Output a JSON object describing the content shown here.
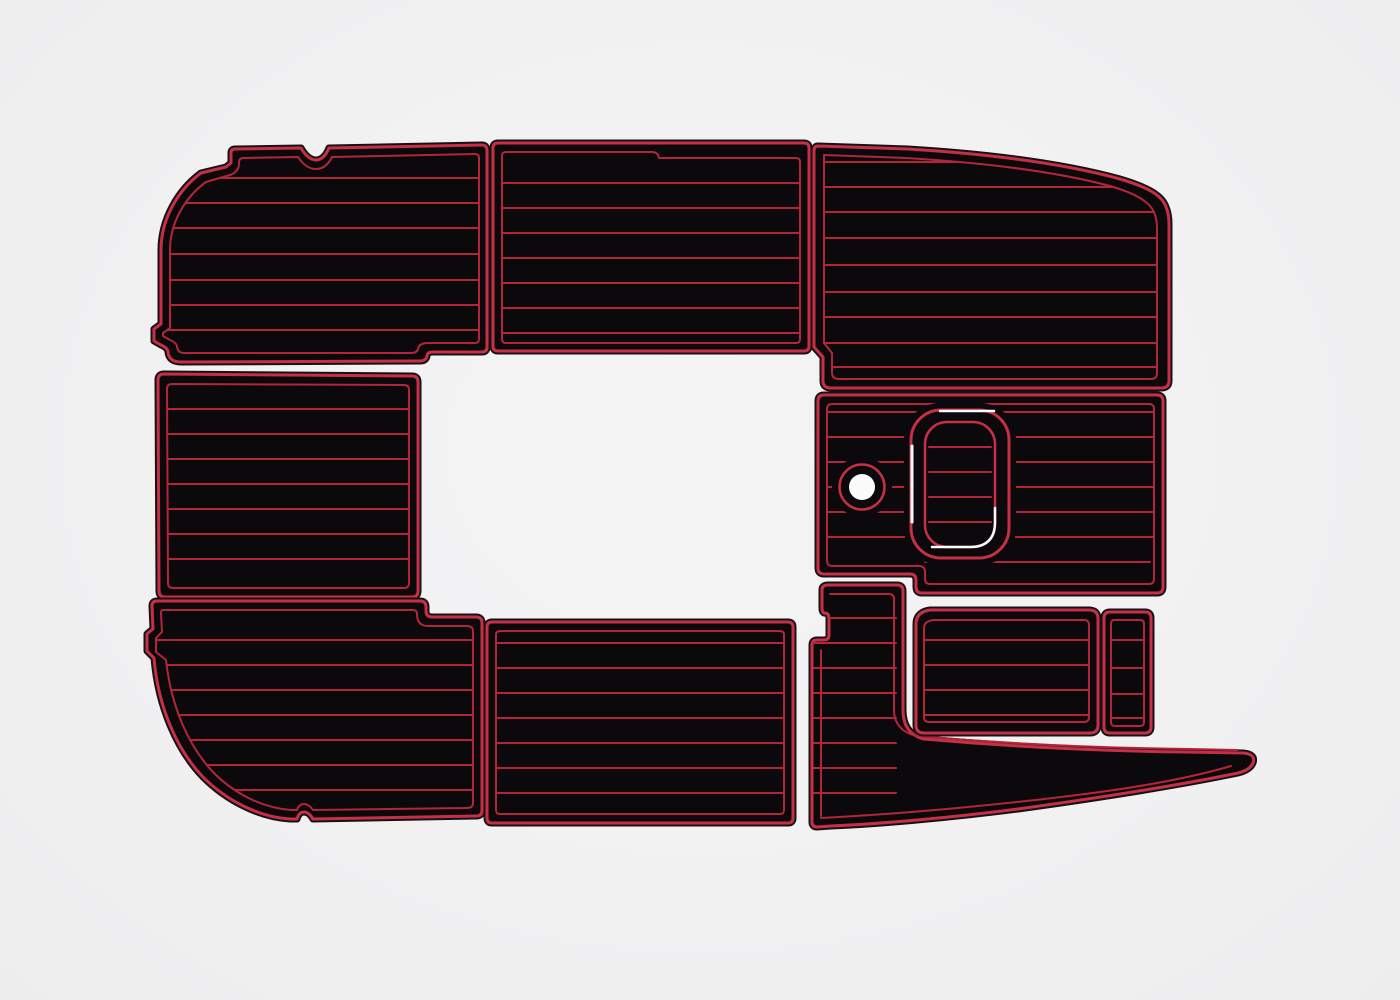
{
  "scene": {
    "width": 1400,
    "height": 1000,
    "colors": {
      "bg": "#f1f1f2",
      "pad": "#0b090c",
      "rim": "#141216",
      "edge": "#c62f44",
      "line": "#b3253a",
      "white": "#fbfbfc"
    }
  },
  "panels": [
    {
      "name": "bow-port-pad",
      "outline": "M 235,149 L 301,148 Q 308,160 316,160 Q 324,160 329,148 L 482,145 Q 487,145 487,151 L 487,347 Q 487,352 482,352 L 433,352 Q 427,352 427,356 Q 426,361 420,361 L 181,362 Q 169,362 168,352 Q 168,348 161,345 L 154,341 L 154,329 L 161,324 L 161,250 C 161,219 178,190 201,173 L 226,167 L 231,163 L 231,153 Q 231,149 235,149 Z",
      "inner": "M 243,158 L 298,157 Q 306,169 316,169 Q 326,169 332,157 L 475,154 Q 479,154 479,158 L 479,339 Q 479,343 475,343 L 428,343 Q 419,343 418,349 Q 417,353 411,353 L 184,353 Q 178,353 177,347 Q 177,343 170,340 L 163,336 L 163,333 L 170,328 L 170,250 C 170,223 185,197 206,182 L 230,175 Q 239,172 239,163 Q 239,158 243,158 Z",
      "clip": "inner",
      "grooves": {
        "x1": 158,
        "x2": 482,
        "ys": [
          178,
          203,
          228,
          254,
          280,
          305,
          330
        ]
      },
      "extras": []
    },
    {
      "name": "bow-center-pad",
      "outline": "M 498,143 L 804,143 Q 809,143 809,148 L 809,346 Q 809,351 804,351 L 498,351 Q 493,351 493,346 L 493,148 Q 493,143 498,143 Z",
      "inner": "M 506,152 L 652,152 Q 658,152 659,158 L 796,158 Q 800,158 800,162 L 800,339 Q 800,343 796,343 L 506,343 Q 502,343 502,339 L 502,156 Q 502,152 506,152 Z",
      "clip": "inner",
      "grooves": {
        "x1": 500,
        "x2": 802,
        "ys": [
          183,
          208,
          233,
          258,
          283,
          308,
          333
        ]
      },
      "extras": []
    },
    {
      "name": "bow-starboard-pad",
      "outline": "M 818,146 L 908,149 C 990,154 1065,164 1120,179 C 1147,187 1162,195 1166,207 Q 1169,214 1169,224 L 1169,381 Q 1169,388 1161,388 L 831,388 Q 823,388 823,381 L 823,357 L 814,347 L 814,151 Q 814,146 818,146 Z",
      "inner": "M 824,155 L 906,158 C 988,163 1058,172 1110,186 C 1134,193 1149,201 1154,212 Q 1157,219 1157,228 L 1157,373 Q 1157,379 1151,379 L 839,379 Q 832,379 832,372 L 832,353 L 824,343 Z",
      "clip": "inner",
      "grooves": {
        "x1": 820,
        "x2": 1160,
        "ys": [
          162,
          187,
          212,
          238,
          265,
          292,
          317,
          343,
          367
        ]
      },
      "extras": []
    },
    {
      "name": "midship-port-pad",
      "outline": "M 164,374 L 412,376 Q 418,376 418,382 L 418,591 Q 418,597 412,597 L 165,597 Q 159,597 159,591 L 158,380 Q 158,374 164,374 Z",
      "inner": "M 172,384 L 404,385 Q 409,385 409,390 L 409,583 Q 409,588 404,588 L 173,588 Q 168,588 168,583 L 167,389 Q 167,384 172,384 Z",
      "clip": "inner",
      "grooves": {
        "x1": 164,
        "x2": 412,
        "ys": [
          409,
          434,
          459,
          484,
          509,
          534,
          559
        ]
      },
      "extras": []
    },
    {
      "name": "helm-deck-pad",
      "outline": "M 824,395 L 1157,395 Q 1163,395 1163,401 L 1163,587 Q 1163,593 1157,593 L 922,593 Q 916,593 916,587 L 916,580 Q 916,574 910,574 L 824,574 Q 818,574 818,568 L 818,401 Q 818,395 824,395 Z",
      "inner": "M 832,404 L 1149,404 Q 1154,404 1154,409 L 1154,579 Q 1154,584 1149,584 L 930,584 Q 925,584 925,579 L 925,572 Q 925,566 919,566 L 833,566 Q 827,566 827,561 L 827,409 Q 827,404 832,404 Z",
      "clip": "inner",
      "grooves": {
        "x1": 822,
        "x2": 1158,
        "ys": [
          412,
          437,
          462,
          487,
          512,
          537
        ]
      },
      "extras": [
        {
          "t": "line",
          "x1": 925,
          "y1": 562,
          "x2": 1150,
          "y2": 562,
          "s": "line",
          "sw": 2
        },
        {
          "t": "rect",
          "x": 904,
          "y": 403,
          "w": 112,
          "h": 162,
          "rx": 36,
          "f": "pad"
        },
        {
          "t": "rect",
          "x": 911,
          "y": 410,
          "w": 98,
          "h": 148,
          "rx": 30,
          "s": "edge",
          "sw": 3
        },
        {
          "t": "path",
          "d": "M 912,446 L 912,522",
          "s": "white",
          "sw": 3
        },
        {
          "t": "path",
          "d": "M 940,411 L 994,411",
          "s": "white",
          "sw": 2.5
        },
        {
          "t": "circle",
          "cx": 862,
          "cy": 487,
          "r": 30,
          "f": "pad"
        },
        {
          "t": "circle",
          "cx": 862,
          "cy": 487,
          "r": 22.5,
          "s": "edge",
          "sw": 2.5
        },
        {
          "t": "circle",
          "cx": 862,
          "cy": 487,
          "r": 13,
          "f": "white"
        },
        {
          "t": "rect",
          "x": 925,
          "y": 422,
          "w": 70,
          "h": 125,
          "rx": 22,
          "f": "pad",
          "s": "edge",
          "sw": 2.5
        },
        {
          "t": "line",
          "x1": 929,
          "y1": 447,
          "x2": 991,
          "y2": 447,
          "s": "line",
          "sw": 2
        },
        {
          "t": "line",
          "x1": 929,
          "y1": 472,
          "x2": 991,
          "y2": 472,
          "s": "line",
          "sw": 2
        },
        {
          "t": "line",
          "x1": 929,
          "y1": 497,
          "x2": 991,
          "y2": 497,
          "s": "line",
          "sw": 2
        },
        {
          "t": "line",
          "x1": 929,
          "y1": 522,
          "x2": 991,
          "y2": 522,
          "s": "line",
          "sw": 2
        },
        {
          "t": "path",
          "d": "M 932,547 L 970,547 Q 995,547 995,522 L 995,508",
          "s": "white",
          "sw": 2.5
        }
      ]
    },
    {
      "name": "aft-port-pad",
      "outline": "M 157,601 L 420,601 Q 426,601 426,607 L 426,611 Q 426,617 432,617 L 476,617 Q 482,617 482,623 L 482,811 Q 482,816 476,816 L 313,819 Q 309,812 304,812 Q 299,812 297,819 L 290,819 C 258,817 226,800 203,777 C 177,750 158,707 154,658 L 147,651 L 147,634 L 153,629 L 152,606 Q 152,601 157,601 Z",
      "inner": "M 163,610 L 413,610 Q 417,610 417,614 Q 417,626 428,626 L 467,626 Q 473,626 473,631 L 473,803 Q 473,808 467,808 L 313,810 Q 309,804 304,804 Q 299,804 297,810 L 291,810 C 262,808 233,793 212,771 C 188,745 171,706 166,660 L 156,652 L 156,638 L 162,632 L 161,613 Q 161,610 163,610 Z",
      "clip": "inner",
      "grooves": {
        "x1": 150,
        "x2": 478,
        "ys": [
          640,
          665,
          690,
          715,
          740,
          765,
          790
        ]
      },
      "extras": []
    },
    {
      "name": "aft-center-pad",
      "outline": "M 492,622 L 788,622 Q 793,622 793,627 L 793,818 Q 793,823 788,823 L 492,823 Q 487,823 487,818 L 487,627 Q 487,622 492,622 Z",
      "inner": "M 500,631 L 780,631 Q 784,631 784,635 L 784,810 Q 784,814 780,814 L 500,814 Q 496,814 496,810 L 496,635 Q 496,631 500,631 Z",
      "clip": "inner",
      "grooves": {
        "x1": 490,
        "x2": 790,
        "ys": [
          643,
          668,
          693,
          718,
          743,
          768,
          793
        ]
      },
      "extras": []
    },
    {
      "name": "starboard-walkway-pad",
      "outline": "M 828,585 L 897,585 Q 903,585 903,591 L 903,710 Q 903,734 924,739 C 1015,747 1110,751 1185,752 L 1243,753 Q 1256,754 1253,763 Q 1250,770 1238,773 C 1175,786 1098,798 1018,809 C 948,818 878,824 831,826 L 817,827 Q 812,827 812,822 L 812,645 Q 812,640 817,640 L 824,640 Q 829,640 829,635 L 829,618 Q 829,613 824,613 Q 822,612 822,608 L 822,590 Q 822,585 828,585 Z",
      "inner": null,
      "clip": "outline",
      "grooves": {
        "x1": 814,
        "x2": 896,
        "ys": [
          618,
          643,
          668,
          693,
          718,
          743,
          768,
          793
        ]
      },
      "extras": [
        {
          "t": "path",
          "d": "M 830,594 L 889,594 Q 894,594 894,599 L 894,710 Q 894,730 916,736 C 1010,744 1110,748 1190,749 L 1237,750",
          "s": "line",
          "sw": 2
        },
        {
          "t": "path",
          "d": "M 821,650 L 821,816",
          "s": "line",
          "sw": 2
        },
        {
          "t": "path",
          "d": "M 821,818 C 900,814 1000,805 1085,794 C 1140,787 1190,778 1231,766",
          "s": "line",
          "sw": 2
        }
      ]
    },
    {
      "name": "transom-box-pad",
      "outline": "M 930,610 L 1089,610 Q 1098,610 1098,619 L 1098,725 Q 1098,733 1090,733 L 924,733 Q 916,733 916,725 L 916,624 Q 916,612 930,610 Z",
      "inner": "M 934,620 L 1084,620 Q 1089,620 1089,625 L 1089,717 Q 1089,722 1084,722 L 929,722 Q 924,722 924,717 L 924,628 Q 924,621 934,620 Z",
      "clip": "inner",
      "grooves": {
        "x1": 920,
        "x2": 1094,
        "ys": [
          640,
          665,
          690,
          715
        ]
      },
      "extras": []
    },
    {
      "name": "transom-step-pad",
      "outline": "M 1110,612 L 1145,612 Q 1151,612 1151,618 L 1151,727 Q 1151,733 1145,733 L 1110,733 Q 1104,733 1104,727 L 1104,618 Q 1104,612 1110,612 Z",
      "inner": "M 1114,620 L 1140,620 Q 1144,620 1144,624 L 1144,722 Q 1144,726 1140,726 L 1115,726 Q 1111,726 1111,722 L 1111,624 Q 1111,620 1114,620 Z",
      "clip": "inner",
      "grooves": {
        "x1": 1108,
        "x2": 1148,
        "ys": [
          640,
          668,
          694,
          718
        ]
      },
      "extras": []
    }
  ]
}
